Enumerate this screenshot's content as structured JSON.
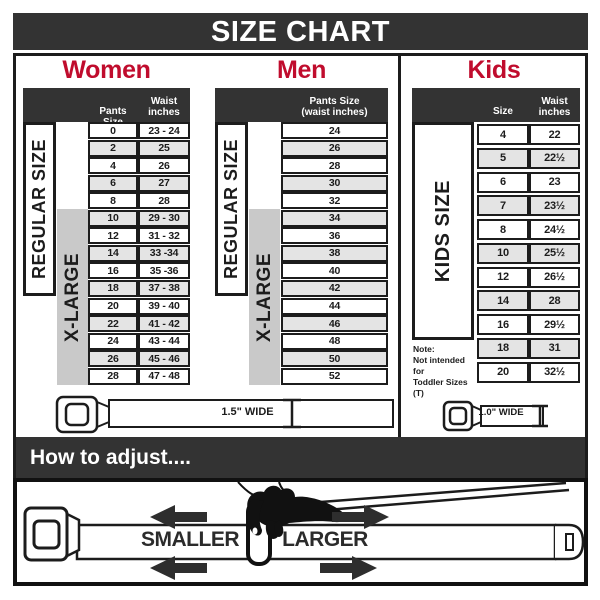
{
  "title": "SIZE CHART",
  "women": {
    "heading": "Women",
    "header": {
      "pants": "Pants Size",
      "waist": "Waist\ninches"
    },
    "regular_label": "REGULAR SIZE",
    "xlarge_label": "X-LARGE",
    "rows": [
      {
        "size": "0",
        "waist": "23 - 24"
      },
      {
        "size": "2",
        "waist": "25"
      },
      {
        "size": "4",
        "waist": "26"
      },
      {
        "size": "6",
        "waist": "27"
      },
      {
        "size": "8",
        "waist": "28"
      },
      {
        "size": "10",
        "waist": "29 - 30"
      },
      {
        "size": "12",
        "waist": "31 - 32"
      },
      {
        "size": "14",
        "waist": "33 -34"
      },
      {
        "size": "16",
        "waist": "35 -36"
      },
      {
        "size": "18",
        "waist": "37 - 38"
      },
      {
        "size": "20",
        "waist": "39 - 40"
      },
      {
        "size": "22",
        "waist": "41 - 42"
      },
      {
        "size": "24",
        "waist": "43 - 44"
      },
      {
        "size": "26",
        "waist": "45 - 46"
      },
      {
        "size": "28",
        "waist": "47 - 48"
      }
    ],
    "belt_label": "1.5\" WIDE"
  },
  "men": {
    "heading": "Men",
    "header": {
      "pants": "Pants Size\n(waist inches)"
    },
    "regular_label": "REGULAR SIZE",
    "xlarge_label": "X-LARGE",
    "rows": [
      "24",
      "26",
      "28",
      "30",
      "32",
      "34",
      "36",
      "38",
      "40",
      "42",
      "44",
      "46",
      "48",
      "50",
      "52"
    ]
  },
  "kids": {
    "heading": "Kids",
    "header": {
      "size": "Size",
      "waist": "Waist\ninches"
    },
    "kids_label": "KIDS SIZE",
    "rows": [
      {
        "size": "4",
        "waist": "22"
      },
      {
        "size": "5",
        "waist": "22½"
      },
      {
        "size": "6",
        "waist": "23"
      },
      {
        "size": "7",
        "waist": "23½"
      },
      {
        "size": "8",
        "waist": "24½"
      },
      {
        "size": "10",
        "waist": "25½"
      },
      {
        "size": "12",
        "waist": "26½"
      },
      {
        "size": "14",
        "waist": "28"
      },
      {
        "size": "16",
        "waist": "29½"
      },
      {
        "size": "18",
        "waist": "31"
      },
      {
        "size": "20",
        "waist": "32½"
      }
    ],
    "note": "Note:\nNot intended for\nToddler Sizes (T)",
    "belt_label": "1.0\" WIDE"
  },
  "adjust": {
    "heading": "How to adjust....",
    "smaller": "SMALLER",
    "larger": "LARGER"
  },
  "colors": {
    "accent_red": "#c00c2d",
    "panel_dark": "#333333",
    "row_alt": "#e4e4e4",
    "xl_gray": "#c9c9c9",
    "line": "#1c1c1c"
  }
}
